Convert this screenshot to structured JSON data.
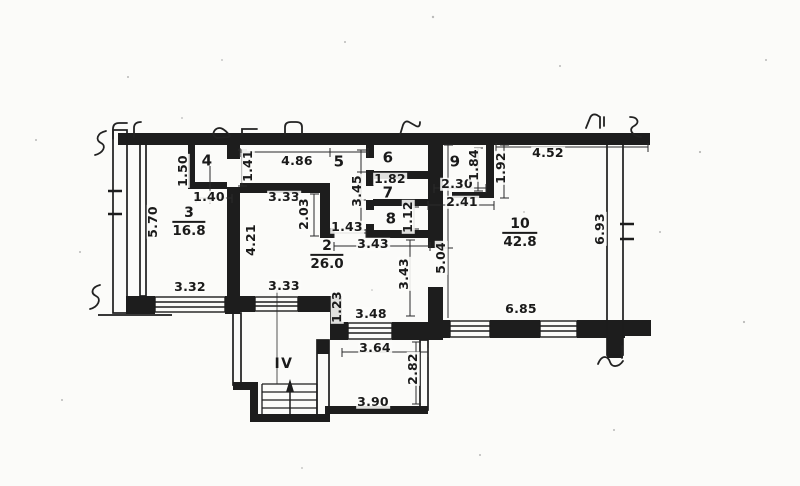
{
  "plan": {
    "stairwell": {
      "label": "IV"
    },
    "rooms": {
      "r2": {
        "number": "2",
        "area": "26.0"
      },
      "r3": {
        "number": "3",
        "area": "16.8"
      },
      "r4": {
        "number": "4"
      },
      "r5": {
        "number": "5"
      },
      "r6": {
        "number": "6"
      },
      "r7": {
        "number": "7"
      },
      "r8": {
        "number": "8"
      },
      "r9": {
        "number": "9"
      },
      "r10": {
        "number": "10",
        "area": "42.8"
      }
    },
    "dims": {
      "d486": "4.86",
      "d150": "1.50",
      "d140": "1.40",
      "d141": "1.41",
      "d570": "5.70",
      "d333_top": "3.33",
      "d203": "2.03",
      "d345": "3.45",
      "d182": "1.82",
      "d112": "1.12",
      "d143": "1.43",
      "d343_mid": "3.43",
      "d421": "4.21",
      "d184": "1.84",
      "d192": "1.92",
      "d452": "4.52",
      "d230": "2.30",
      "d241": "2.41",
      "d504": "5.04",
      "d343_vert": "3.43",
      "d693": "6.93",
      "d332": "3.32",
      "d333_bottom": "3.33",
      "d123": "1.23",
      "d348": "3.48",
      "d364": "3.64",
      "d685": "6.85",
      "d282": "2.82",
      "d390": "3.90"
    },
    "colors": {
      "ink": "#1d1d1d",
      "paper": "#fbfbf9"
    }
  }
}
